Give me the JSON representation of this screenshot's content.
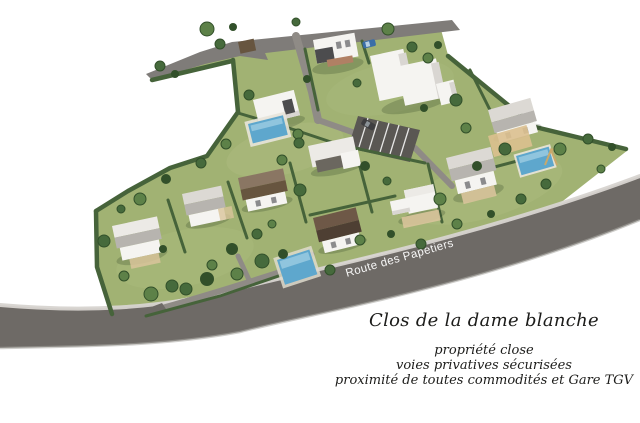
{
  "scene": {
    "road_label": "Route des Papetiers",
    "title": "Clos de la dame blanche",
    "tagline": {
      "line1": "propriété close",
      "line2": "voies privatives sécurisées",
      "line3": "proximité de toutes commodités et Gare TGV"
    }
  },
  "palette": {
    "background": "#ffffff",
    "grass": "#a1b273",
    "grass_light": "#b6c288",
    "hedge": "#46633a",
    "tree": "#466a3c",
    "tree_light": "#5d8148",
    "tree_dark": "#32502a",
    "road_main": "#6e6a66",
    "road_top": "#7f7c79",
    "sidewalk": "#d7d4d0",
    "lane": "#8f8b86",
    "parking": "#5a5753",
    "wall": "#f5f4f1",
    "wall_shade": "#d9d6d2",
    "roof_light": "#dcd9d4",
    "roof_mid": "#b7b4af",
    "roof_white": "#eceae6",
    "roof_brown": "#8a7663",
    "roof_brown_dark": "#67553f",
    "charcoal": "#4c4c4e",
    "brick": "#b08064",
    "pool": "#5ea7cd",
    "pool_light": "#a5d2e6",
    "deck": "#d9c49b",
    "sand": "#dcc08f",
    "car_blue": "#3a6ea8",
    "car_dark": "#3e3e40",
    "text": "#1c1c1a",
    "label": "#ffffff"
  }
}
